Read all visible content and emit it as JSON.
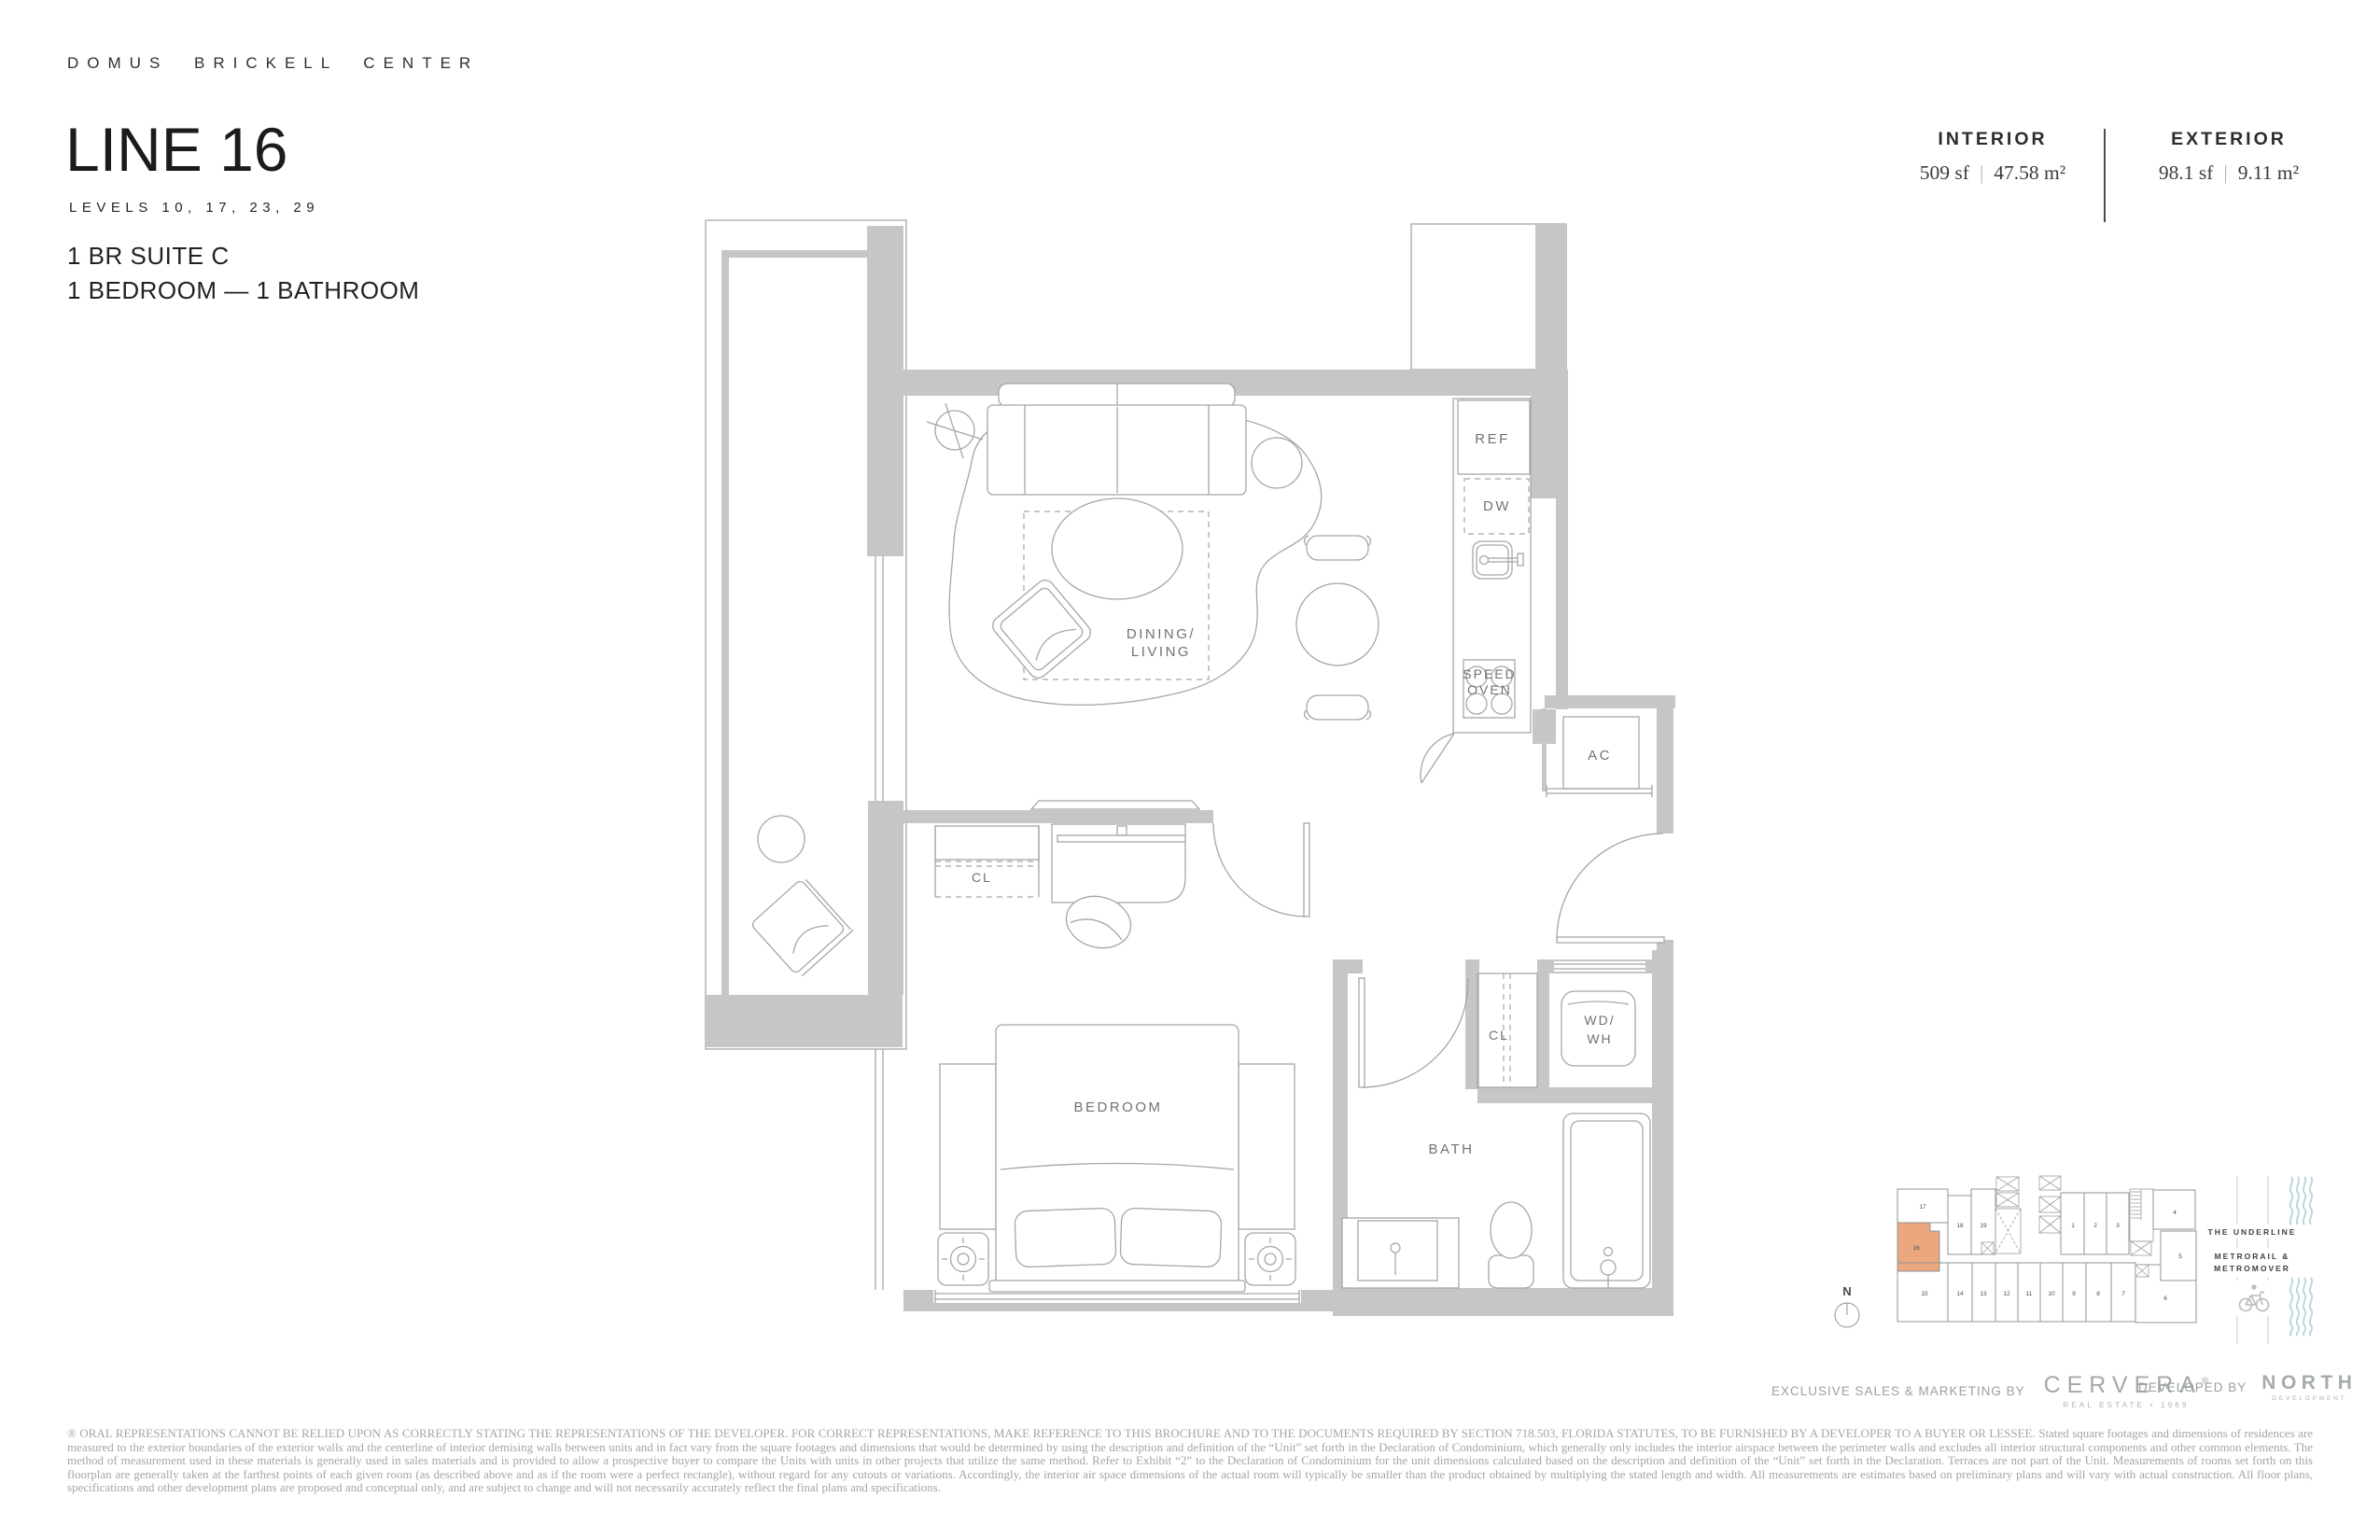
{
  "header": {
    "brand": "DOMUS BRICKELL CENTER",
    "title": "LINE 16",
    "levels": "LEVELS 10, 17, 23, 29",
    "suite": "1 BR SUITE C",
    "config": "1 BEDROOM — 1 BATHROOM"
  },
  "areas": {
    "interior_label": "INTERIOR",
    "interior_sf": "509 sf",
    "interior_m2": "47.58 m²",
    "exterior_label": "EXTERIOR",
    "exterior_sf": "98.1 sf",
    "exterior_m2": "9.11 m²",
    "separator": "|"
  },
  "plan": {
    "labels": {
      "ref": "REF",
      "dw": "DW",
      "speed1": "SPEED",
      "speed2": "OVEN",
      "ac": "AC",
      "dining1": "DINING/",
      "dining2": "LIVING",
      "bedroom_closet": "CL",
      "bedroom": "BEDROOM",
      "bath": "BATH",
      "linen_closet": "CL",
      "wd1": "WD/",
      "wd2": "WH"
    }
  },
  "keyplan": {
    "north": "N",
    "highlighted_unit": "16",
    "highlight_color": "#EBA87E",
    "units": {
      "u1": "1",
      "u2": "2",
      "u3": "3",
      "u4": "4",
      "u5": "5",
      "u6": "6",
      "u7": "7",
      "u8": "8",
      "u9": "9",
      "u10": "10",
      "u11": "11",
      "u12": "12",
      "u13": "13",
      "u14": "14",
      "u15": "15",
      "u16": "16",
      "u17": "17",
      "u18": "18",
      "u19": "19"
    },
    "underline": "THE UNDERLINE",
    "transit1": "METRORAIL &",
    "transit2": "METROMOVER"
  },
  "footer": {
    "sales_prefix": "EXCLUSIVE SALES & MARKETING BY",
    "cervera": "CERVERA",
    "cervera_reg": "®",
    "cervera_sub": "REAL ESTATE • 1969",
    "developed_prefix": "DEVELOPED BY",
    "north": "NORTH",
    "north_sub": "DEVELOPMENT"
  },
  "disclaimer": "® ORAL REPRESENTATIONS CANNOT BE RELIED UPON AS CORRECTLY STATING THE REPRESENTATIONS OF THE DEVELOPER. FOR CORRECT REPRESENTATIONS, MAKE REFERENCE TO THIS BROCHURE AND TO THE DOCUMENTS REQUIRED BY SECTION 718.503, FLORIDA STATUTES, TO BE FURNISHED BY A DEVELOPER TO A BUYER OR LESSEE.  Stated square footages and dimensions of residences are measured to the exterior boundaries of the exterior walls and the centerline of interior demising walls between units and in fact vary from the square footages and dimensions that would be determined by using the description and definition of the “Unit” set forth in the Declaration of Condominium, which generally only includes the interior airspace between the perimeter walls and excludes all interior structural components and other common elements.  The method of measurement used in these materials is generally used in sales materials and is provided to allow a prospective buyer to compare the Units with units in other projects that utilize the same method. Refer to Exhibit “2” to the Declaration of Condominium for the unit dimensions calculated based on the description and definition of the “Unit” set forth in the Declaration. Terraces are not part of the Unit.  Measurements of rooms set forth on this floorplan are generally taken at the farthest points of each given room (as described above and as if the room were a perfect rectangle), without regard for any cutouts or variations.  Accordingly, the interior air space dimensions of the actual room will typically be smaller than the product obtained by multiplying the stated length and width.  All measurements are estimates based on preliminary plans and will vary with actual construction. All floor plans, specifications and other development plans are proposed and conceptual only, and are subject to change and will not necessarily accurately reflect the final plans and specifications."
}
